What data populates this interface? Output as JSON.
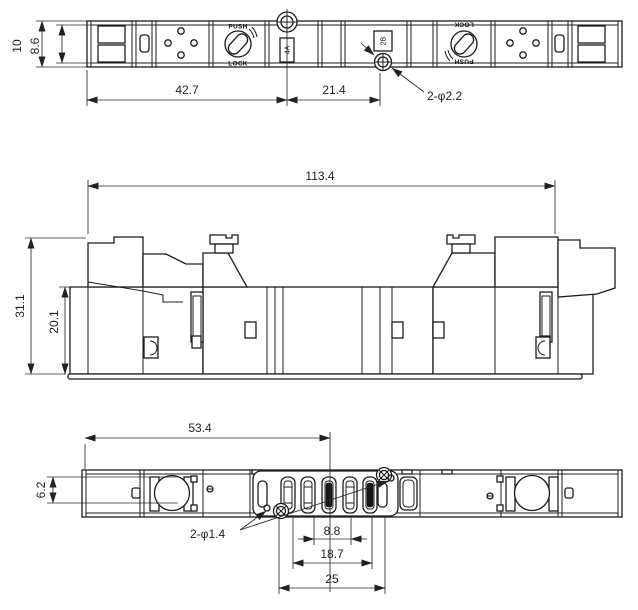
{
  "drawing": {
    "views": {
      "top": {
        "dim_height_outer": "10",
        "dim_height_inner": "8.6",
        "dim_width_left": "42.7",
        "dim_width_right": "21.4",
        "hole_callout": "2-φ2.2",
        "knob_push": "PUSH",
        "knob_lock": "LOCK",
        "port_a": "4A",
        "port_b": "2B"
      },
      "front": {
        "dim_overall_width": "113.4",
        "dim_overall_height": "31.1",
        "dim_body_height": "20.1"
      },
      "bottom": {
        "dim_width": "53.4",
        "dim_port_height": "6.2",
        "hole_callout": "2-φ1.4",
        "dim_pitch_small": "8.8",
        "dim_pitch_mid": "18.7",
        "dim_pitch_large": "25"
      }
    }
  }
}
